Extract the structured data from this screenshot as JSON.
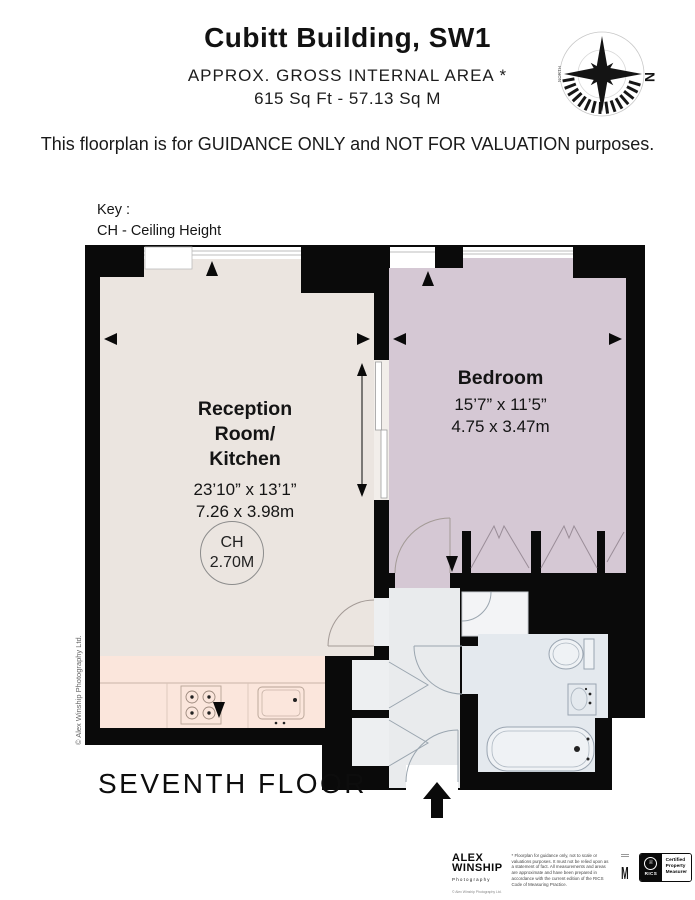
{
  "header": {
    "title": "Cubitt Building, SW1",
    "subtitle": "APPROX. GROSS INTERNAL  AREA *",
    "area_line": "615 Sq Ft  -  57.13 Sq M"
  },
  "disclaimer": "This floorplan is for GUIDANCE ONLY and NOT FOR VALUATION purposes.",
  "key": {
    "title": "Key :",
    "ceiling_height": "CH - Ceiling Height"
  },
  "compass": {
    "north": "N",
    "north_word": "NORTH"
  },
  "rooms": {
    "reception": {
      "name_line1": "Reception",
      "name_line2": "Room/",
      "name_line3": "Kitchen",
      "imperial": "23’10” x 13’1”",
      "metric": "7.26 x 3.98m"
    },
    "bedroom": {
      "name": "Bedroom",
      "imperial": "15’7” x 11’5”",
      "metric": "4.75 x 3.47m"
    },
    "ceiling": {
      "abbr": "CH",
      "value": "2.70M"
    }
  },
  "floor_label": "SEVENTH FLOOR",
  "side_credit": "© Alex Winship Photography Ltd.",
  "footer": {
    "photographer_line1": "ALEX",
    "photographer_line2": "WINSHIP",
    "photographer_sub": "Photography",
    "photographer_credit": "© Alex Winship Photography Ltd.",
    "fine_print": "* Floorplan for guidance only, not to scale or valuations purposes. It must not be relied upon as a statement of fact. All measurements and areas are approximate and have been prepared in accordance with the current edition of the RICS Code of Measuring Practice.",
    "m_mark": "M",
    "rics_emblem": "♕",
    "rics": "RICS",
    "certified_line1": "Certified",
    "certified_line2": "Property",
    "certified_line3": "Measurer"
  },
  "colors": {
    "wall": "#0a0a0a",
    "reception_fill": "#EBE5E0",
    "kitchen_fill": "#FBE6DC",
    "bedroom_fill": "#D5C8D4",
    "hall_fill": "#E9EBED",
    "bath_fill": "#E4E9EE"
  }
}
